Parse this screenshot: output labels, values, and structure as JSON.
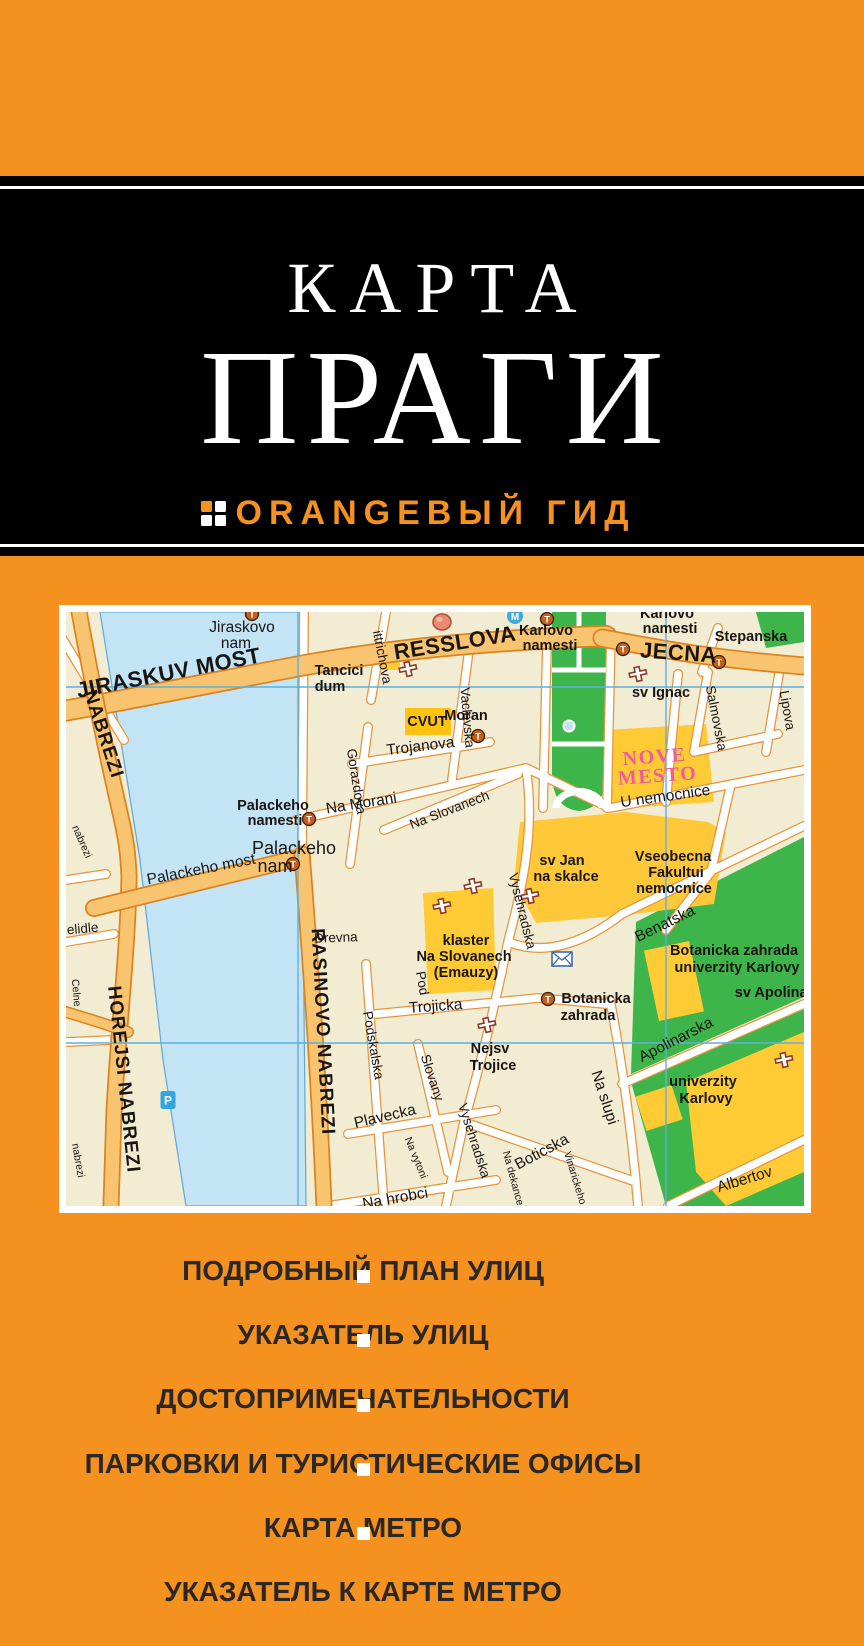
{
  "cover": {
    "title_line1": "КАРТА",
    "title_line2": "ПРАГИ",
    "brand": "ORANGEВЫЙ ГИД"
  },
  "colors": {
    "cover_orange": "#F5911E",
    "band_black": "#000000",
    "map_cream": "#F2ECD2",
    "road_orange": "#F9C46F",
    "road_casing": "#DC831F",
    "river_blue": "#C2E4F4",
    "park_green": "#3DB54A",
    "building_yellow": "#FFCB35",
    "nove_mesto_pink": "#EE5C9C",
    "grid_blue": "#5BB1E2",
    "features_text": "#2B2724"
  },
  "features": {
    "items": [
      "ПОДРОБНЫЙ ПЛАН УЛИЦ",
      "УКАЗАТЕЛЬ УЛИЦ",
      "ДОСТОПРИМЕЧАТЕЛЬНОСТИ",
      "ПАРКОВКИ И ТУРИСТИЧЕСКИЕ ОФИСЫ",
      "КАРТА МЕТРО",
      "УКАЗАТЕЛЬ К КАРТЕ МЕТРО"
    ]
  },
  "map": {
    "labels": [
      {
        "t": "JIRASKUV MOST",
        "x": 104,
        "y": 68,
        "r": -11,
        "c": "R"
      },
      {
        "t": "RESSLOVA",
        "x": 390,
        "y": 38,
        "r": -9,
        "c": "R"
      },
      {
        "t": "JECNA",
        "x": 612,
        "y": 48,
        "r": 4,
        "c": "R"
      },
      {
        "t": "NABREZI",
        "x": 32,
        "y": 124,
        "r": 72,
        "c": "r"
      },
      {
        "t": "HOREJSI NABREZI",
        "x": 52,
        "y": 468,
        "r": 84,
        "c": "r"
      },
      {
        "t": "RASINOVO NABREZI",
        "x": 251,
        "y": 420,
        "r": 87,
        "c": "r"
      },
      {
        "t": "Jiraskovo",
        "x": 176,
        "y": 20,
        "r": 0,
        "c": "s2"
      },
      {
        "t": "nam",
        "x": 170,
        "y": 36,
        "r": 0,
        "c": "s2"
      },
      {
        "t": "ittrichova",
        "x": 312,
        "y": 46,
        "r": 79,
        "c": "s"
      },
      {
        "t": "Gorazdova",
        "x": 286,
        "y": 170,
        "r": 81,
        "c": "s"
      },
      {
        "t": "Vaclavska",
        "x": 397,
        "y": 106,
        "r": 85,
        "c": "s"
      },
      {
        "t": "Trojanova",
        "x": 355,
        "y": 139,
        "r": -7,
        "c": "s2"
      },
      {
        "t": "Na Morani",
        "x": 296,
        "y": 196,
        "r": -9,
        "c": "s2"
      },
      {
        "t": "Palackeho",
        "x": 207,
        "y": 198,
        "r": 0,
        "c": "p"
      },
      {
        "t": "namesti",
        "x": 209,
        "y": 213,
        "r": 0,
        "c": "p"
      },
      {
        "t": "Palackeho most",
        "x": 136,
        "y": 262,
        "r": -11,
        "c": "s2"
      },
      {
        "t": "Palackeho",
        "x": 228,
        "y": 242,
        "r": 0,
        "c": "p2"
      },
      {
        "t": "nam",
        "x": 209,
        "y": 260,
        "r": 0,
        "c": "p2"
      },
      {
        "t": "U nemocnice",
        "x": 600,
        "y": 189,
        "r": -8,
        "c": "s2"
      },
      {
        "t": "Na Slovanech",
        "x": 385,
        "y": 202,
        "r": -21,
        "c": "s"
      },
      {
        "t": "Vysehradska",
        "x": 452,
        "y": 300,
        "r": 76,
        "c": "s"
      },
      {
        "t": "Benatska",
        "x": 601,
        "y": 316,
        "r": -26,
        "c": "s2"
      },
      {
        "t": "Drevna",
        "x": 270,
        "y": 330,
        "r": -2,
        "c": "s"
      },
      {
        "t": "Pod",
        "x": 352,
        "y": 372,
        "r": 80,
        "c": "s"
      },
      {
        "t": "Podskalska",
        "x": 303,
        "y": 434,
        "r": 80,
        "c": "s"
      },
      {
        "t": "Trojicka",
        "x": 370,
        "y": 399,
        "r": -4,
        "c": "s2"
      },
      {
        "t": "Slovany",
        "x": 362,
        "y": 467,
        "r": 72,
        "c": "s"
      },
      {
        "t": "Plavecka",
        "x": 320,
        "y": 509,
        "r": -13,
        "c": "s2"
      },
      {
        "t": "Na vytoni",
        "x": 347,
        "y": 547,
        "r": 68,
        "c": "xs"
      },
      {
        "t": "Vysehradska",
        "x": 404,
        "y": 530,
        "r": 72,
        "c": "s"
      },
      {
        "t": "Boticska",
        "x": 478,
        "y": 544,
        "r": -28,
        "c": "s2"
      },
      {
        "t": "Na hrobci",
        "x": 330,
        "y": 591,
        "r": -10,
        "c": "s2"
      },
      {
        "t": "Na dekance",
        "x": 444,
        "y": 567,
        "r": 75,
        "c": "xs"
      },
      {
        "t": "Vinarickeho",
        "x": 506,
        "y": 567,
        "r": 73,
        "c": "xs"
      },
      {
        "t": "Na slupi",
        "x": 534,
        "y": 487,
        "r": 72,
        "c": "s2"
      },
      {
        "t": "Apolinarska",
        "x": 612,
        "y": 432,
        "r": -27,
        "c": "s2"
      },
      {
        "t": "Albertov",
        "x": 680,
        "y": 572,
        "r": -17,
        "c": "s2"
      },
      {
        "t": "Salmovska",
        "x": 646,
        "y": 107,
        "r": 79,
        "c": "s"
      },
      {
        "t": "Lipova",
        "x": 717,
        "y": 99,
        "r": 80,
        "c": "s"
      },
      {
        "t": "elidle",
        "x": 17,
        "y": 321,
        "r": -5,
        "c": "s"
      },
      {
        "t": "Celne",
        "x": 7,
        "y": 381,
        "r": 85,
        "c": "xs"
      },
      {
        "t": "nabrezi",
        "x": 13,
        "y": 231,
        "r": 66,
        "c": "xs"
      },
      {
        "t": "nabrezi",
        "x": 9,
        "y": 549,
        "r": 80,
        "c": "xs"
      },
      {
        "t": "Karlovo",
        "x": 480,
        "y": 23,
        "r": 0,
        "c": "p"
      },
      {
        "t": "namesti",
        "x": 484,
        "y": 38,
        "r": 0,
        "c": "p"
      },
      {
        "t": "Karlovo",
        "x": 601,
        "y": 6,
        "r": 0,
        "c": "p"
      },
      {
        "t": "namesti",
        "x": 604,
        "y": 21,
        "r": 0,
        "c": "p"
      },
      {
        "t": "Stepanska",
        "x": 685,
        "y": 29,
        "r": 0,
        "c": "p"
      },
      {
        "t": "sv Ignac",
        "x": 595,
        "y": 85,
        "r": 0,
        "c": "p"
      },
      {
        "t": "Moran",
        "x": 400,
        "y": 108,
        "r": 0,
        "c": "p"
      },
      {
        "t": "Tancici",
        "x": 273,
        "y": 63,
        "r": 0,
        "c": "p"
      },
      {
        "t": "dum",
        "x": 264,
        "y": 79,
        "r": 0,
        "c": "p"
      },
      {
        "t": "CVUT",
        "x": 361,
        "y": 114,
        "r": 0,
        "c": "p"
      },
      {
        "t": "sv Jan",
        "x": 496,
        "y": 253,
        "r": 0,
        "c": "p"
      },
      {
        "t": "na skalce",
        "x": 500,
        "y": 269,
        "r": 0,
        "c": "p"
      },
      {
        "t": "Vseobecna",
        "x": 607,
        "y": 249,
        "r": 0,
        "c": "p"
      },
      {
        "t": "Fakultui",
        "x": 610,
        "y": 265,
        "r": 0,
        "c": "p"
      },
      {
        "t": "nemocnice",
        "x": 608,
        "y": 281,
        "r": 0,
        "c": "p"
      },
      {
        "t": "klaster",
        "x": 400,
        "y": 333,
        "r": 0,
        "c": "p"
      },
      {
        "t": "Na Slovanech",
        "x": 398,
        "y": 349,
        "r": 0,
        "c": "p"
      },
      {
        "t": "(Emauzy)",
        "x": 400,
        "y": 365,
        "r": 0,
        "c": "p"
      },
      {
        "t": "Botanicka zahrada",
        "x": 668,
        "y": 343,
        "r": 0,
        "c": "p"
      },
      {
        "t": "univerzity Karlovy",
        "x": 671,
        "y": 360,
        "r": 0,
        "c": "p"
      },
      {
        "t": "sv Apolinar",
        "x": 708,
        "y": 385,
        "r": 0,
        "c": "p"
      },
      {
        "t": "Nejsv",
        "x": 424,
        "y": 441,
        "r": 0,
        "c": "p"
      },
      {
        "t": "Trojice",
        "x": 427,
        "y": 458,
        "r": 0,
        "c": "p"
      },
      {
        "t": "Botanicka",
        "x": 530,
        "y": 391,
        "r": 0,
        "c": "p"
      },
      {
        "t": "zahrada",
        "x": 522,
        "y": 408,
        "r": 0,
        "c": "p"
      },
      {
        "t": "univerzity",
        "x": 637,
        "y": 474,
        "r": 0,
        "c": "p"
      },
      {
        "t": "Karlovy",
        "x": 640,
        "y": 491,
        "r": 0,
        "c": "p"
      },
      {
        "t": "NOVE",
        "x": 589,
        "y": 151,
        "r": -4,
        "c": "nm"
      },
      {
        "t": "MESTO",
        "x": 592,
        "y": 170,
        "r": -4,
        "c": "nm"
      }
    ],
    "icons": [
      {
        "k": "metro",
        "x": 449,
        "y": 4
      },
      {
        "k": "tram",
        "x": 481,
        "y": 7
      },
      {
        "k": "tram",
        "x": 186,
        "y": 2
      },
      {
        "k": "dome",
        "x": 376,
        "y": 10
      },
      {
        "k": "tram",
        "x": 557,
        "y": 37
      },
      {
        "k": "tram",
        "x": 653,
        "y": 50
      },
      {
        "k": "cross",
        "x": 342,
        "y": 57
      },
      {
        "k": "cross",
        "x": 572,
        "y": 62
      },
      {
        "k": "tram",
        "x": 243,
        "y": 207
      },
      {
        "k": "tram",
        "x": 227,
        "y": 252
      },
      {
        "k": "tram",
        "x": 412,
        "y": 124
      },
      {
        "k": "cross",
        "x": 464,
        "y": 284
      },
      {
        "k": "cross",
        "x": 407,
        "y": 274
      },
      {
        "k": "cross",
        "x": 376,
        "y": 294
      },
      {
        "k": "envelope",
        "x": 496,
        "y": 347
      },
      {
        "k": "tram",
        "x": 482,
        "y": 387
      },
      {
        "k": "cross",
        "x": 421,
        "y": 413
      },
      {
        "k": "cross",
        "x": 718,
        "y": 448
      },
      {
        "k": "parking",
        "x": 102,
        "y": 488
      }
    ]
  }
}
